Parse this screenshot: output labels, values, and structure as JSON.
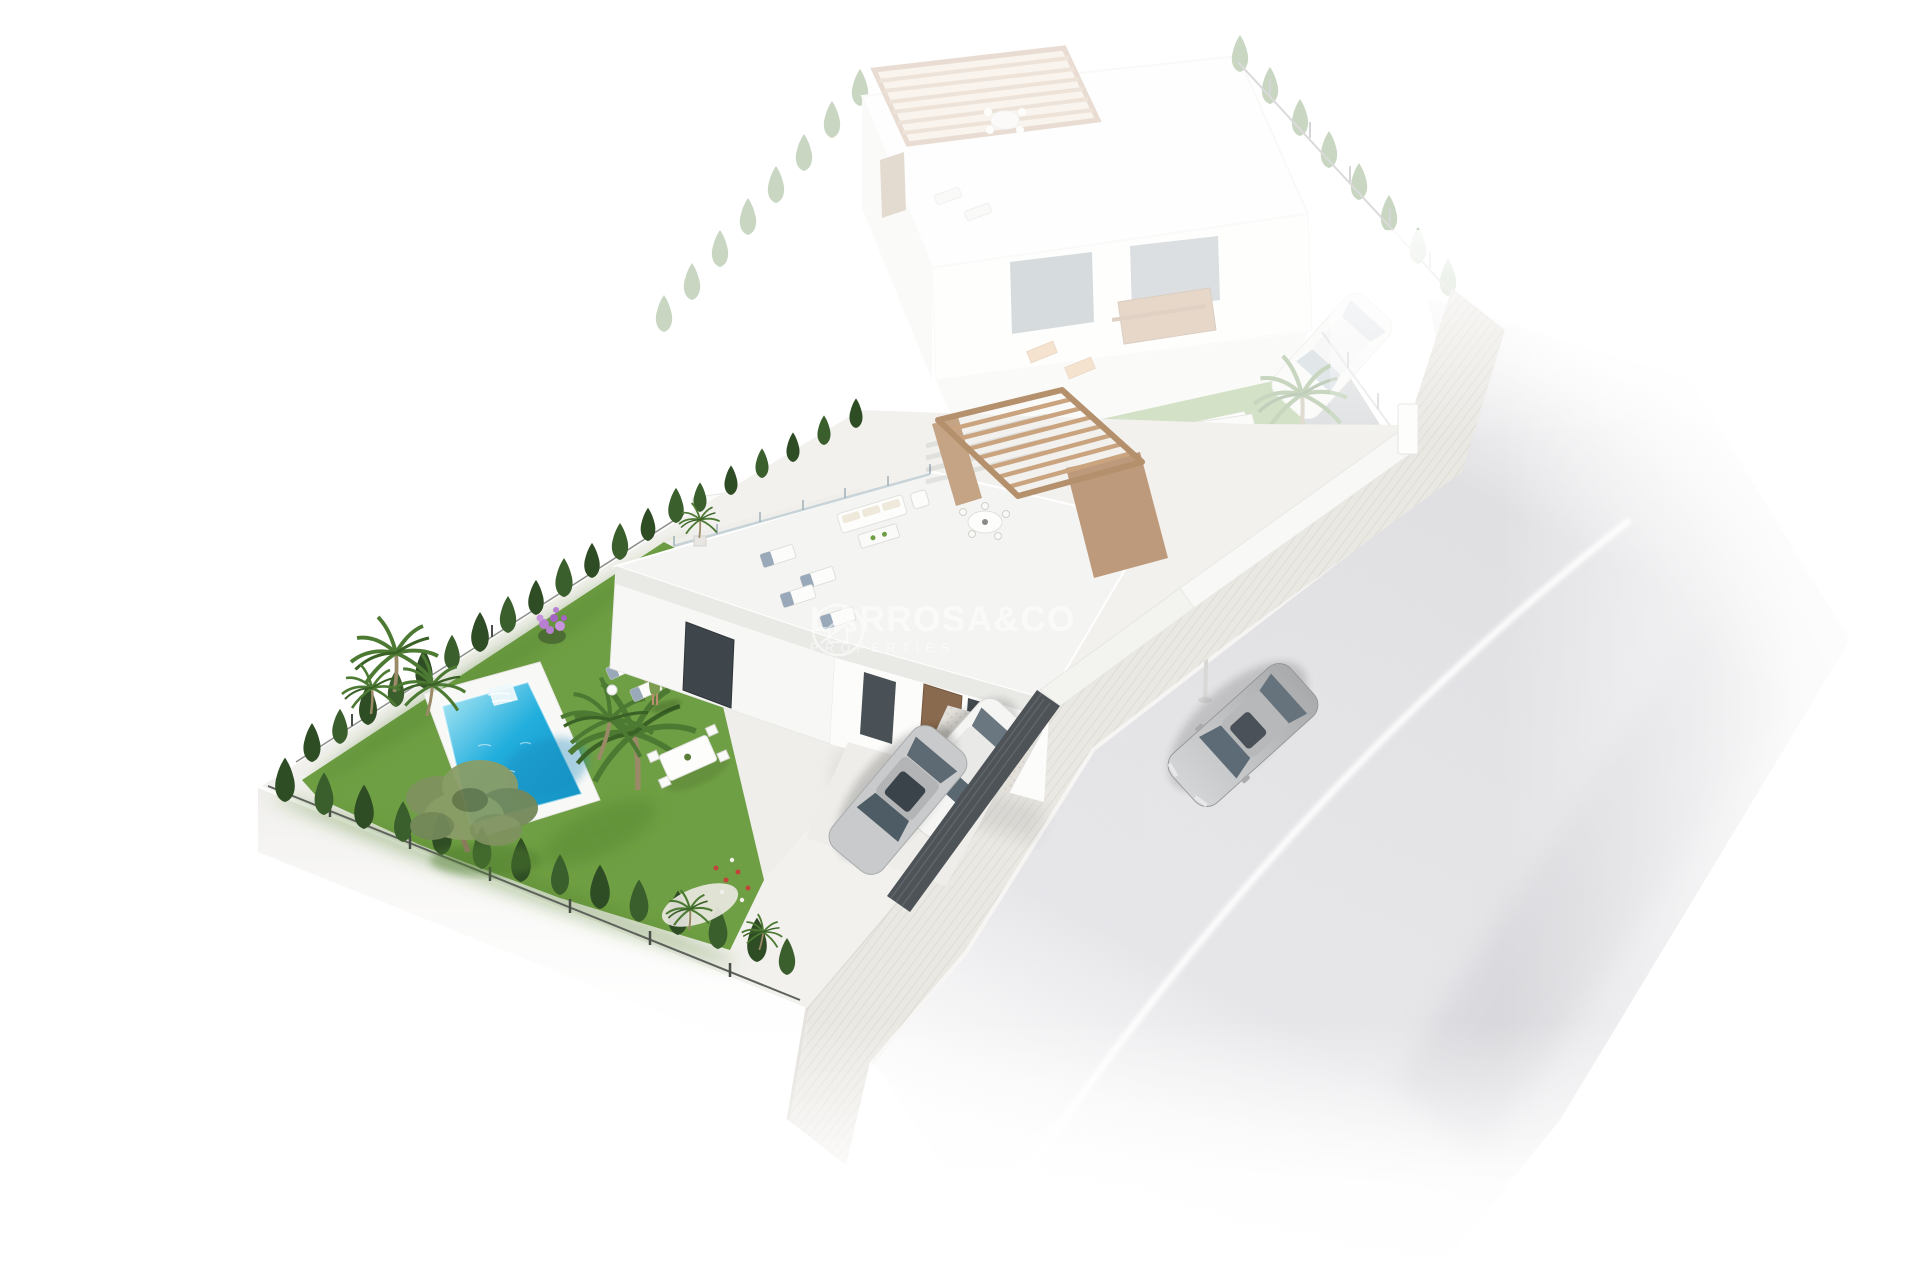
{
  "watermark": {
    "brand": "LARROSA&CO",
    "tagline": "PROPERTIES",
    "logo": "house-in-circle-icon"
  },
  "scene": {
    "objects": [
      "ghost-neighbour-villa",
      "ghost-pool",
      "ghost-parked-car",
      "main-villa",
      "rooftop-pergola",
      "roof-terrace",
      "roof-sun-loungers",
      "roof-sofa-set",
      "roof-dining-table",
      "garden-lawn",
      "swimming-pool",
      "pool-roman-steps",
      "cypress-hedge-rows",
      "palm-trees",
      "olive-tree",
      "bougainvillea-bush",
      "terrace-dining-table",
      "person-on-terrace",
      "sun-loungers",
      "driveway",
      "parked-car-silver",
      "parked-car-white",
      "dark-slatted-gate",
      "sidewalk",
      "asphalt-road",
      "road-centre-line",
      "street-car-silver",
      "street-lamp"
    ]
  },
  "colors": {
    "lawn": "#6f9f44",
    "lawnShade": "#54842f",
    "hedge": "#2f4d24",
    "hedgeAlt": "#3a5e2c",
    "hedgeGhost": "#4f7a38",
    "poolShallow": "#b9ecf6",
    "poolMid": "#22aedd",
    "poolDeep": "#128fc0",
    "deck": "#f8f8f6",
    "terrace": "#efeeea",
    "wall": "#fcfcfb",
    "wallShade": "#f7f7f5",
    "fascia": "#e9e9e6",
    "pergola": "#c5a385",
    "pergolaDark": "#bd9a7b",
    "pergolaFrame": "#b5906c",
    "pergolaSlat": "#c9a47f",
    "fenceDark": "#4e5357",
    "road": "#e6e6e9",
    "roadLine": "#ffffff",
    "sidewalk": "#eae8e3",
    "sidewalkStripe": "#dcd9d2",
    "gravel": "#e3e0da",
    "carSilver": "#c9cacb",
    "carWhite": "#f5f5f4",
    "glass": "#5a6872",
    "watermark": "#ffffff"
  }
}
